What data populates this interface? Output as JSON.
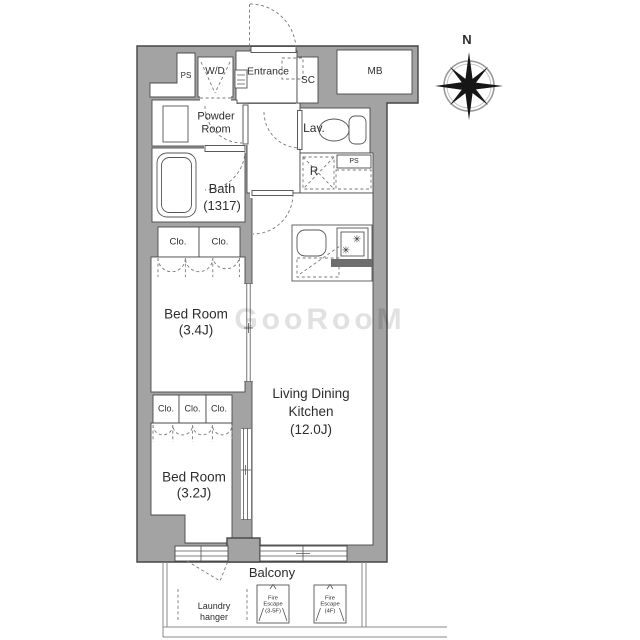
{
  "plan": {
    "compass": "N",
    "watermark": "GooRooM",
    "rooms": {
      "ps_left": "PS",
      "washer_dryer": "W/D",
      "entrance": "Entrance",
      "shoe_closet": "SC",
      "meter_box": "MB",
      "powder_room": [
        "Powder",
        "Room"
      ],
      "lavatory": "Lav.",
      "bath": [
        "Bath",
        "(1317)"
      ],
      "refrigerator": "R",
      "ps_right": "PS",
      "closets_row1": [
        "Clo.",
        "Clo."
      ],
      "closets_row2": [
        "Clo.",
        "Clo.",
        "Clo."
      ],
      "bedroom1": [
        "Bed Room",
        "(3.4J)"
      ],
      "bedroom2": [
        "Bed Room",
        "(3.2J)"
      ],
      "ldk": [
        "Living Dining",
        "Kitchen",
        "(12.0J)"
      ],
      "balcony": "Balcony"
    },
    "balcony_features": {
      "laundry_hanger": [
        "Laundry",
        "hanger"
      ],
      "fire_escape_1": [
        "Fire",
        "Escape",
        "(3-5F)"
      ],
      "fire_escape_2": [
        "Fire",
        "Escape",
        "(4F)"
      ]
    },
    "icons": {
      "stove_burner": "✳"
    },
    "colors": {
      "wall_fill": "#a3a3a3",
      "wall_outline": "#454545",
      "dash_line": "#777777"
    }
  }
}
